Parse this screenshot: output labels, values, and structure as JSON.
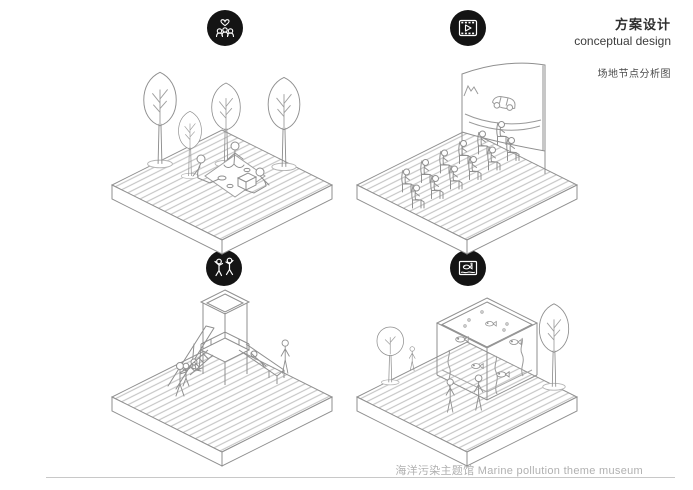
{
  "header": {
    "title_cn": "方案设计",
    "title_en": "conceptual design",
    "diagram_label": "场地节点分析图"
  },
  "panels": [
    {
      "icon": "heart-community-icon",
      "content": "lawn picnic node: four trees, people seated on picnic blanket with basket"
    },
    {
      "icon": "film-play-icon",
      "content": "open-air cinema node: two rows of seats facing curved screen showing a car"
    },
    {
      "icon": "children-playing-icon",
      "content": "children playground node: canopy tower, slide, ladder and swing with figures"
    },
    {
      "icon": "aquarium-icon",
      "content": "aquarium exhibit node: glass fish tank with seaweed and fish, trees and visitors"
    }
  ],
  "footer": {
    "caption": "海洋污染主题馆 Marine pollution theme museum"
  },
  "colors": {
    "line": "#8f8f8f",
    "hatch": "#bdbdbd",
    "icon_bg": "#141414",
    "title_text": "#2f2f2f",
    "footer_text": "#b0b0b0",
    "rule": "#c8c8c8"
  }
}
